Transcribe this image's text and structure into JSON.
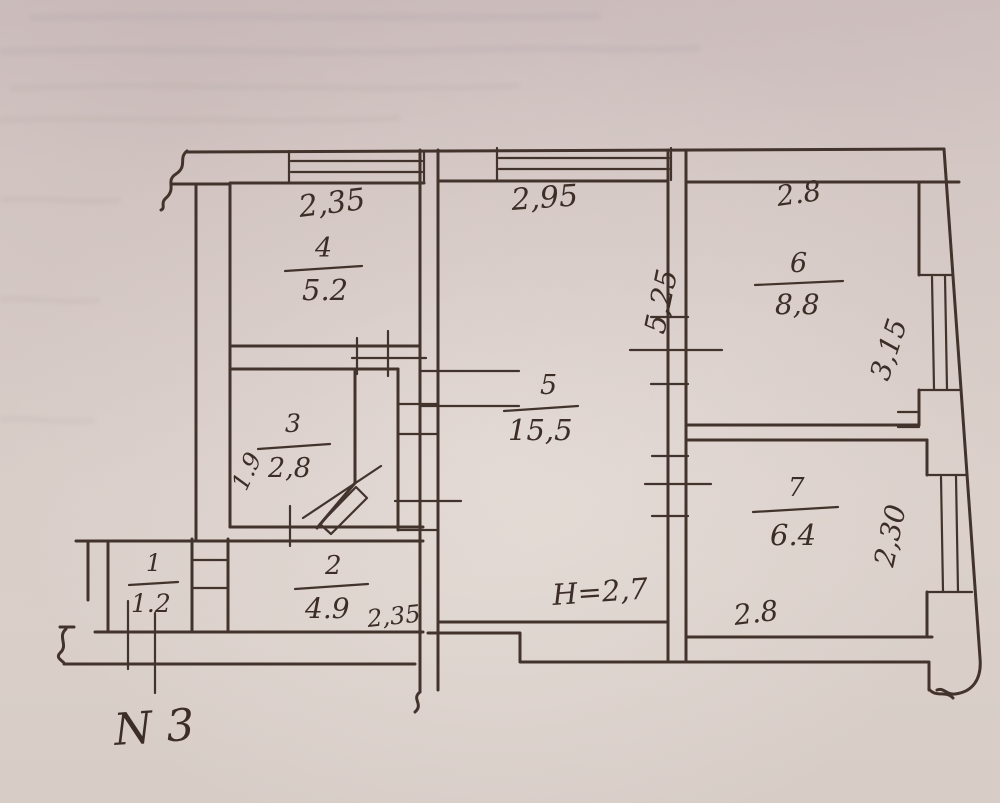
{
  "title": "apartment floor plan sketch",
  "apartment_label": "N 3",
  "colors": {
    "paper": "#d6cbc7",
    "ink": "#42342c"
  },
  "rooms": {
    "r1": {
      "number": "1",
      "area": "1.2"
    },
    "r2": {
      "number": "2",
      "area": "4.9",
      "width": "2,35"
    },
    "r3": {
      "number": "3",
      "area": "2,8",
      "depth": "1.9"
    },
    "r4": {
      "number": "4",
      "area": "5.2",
      "width": "2,35"
    },
    "r5": {
      "number": "5",
      "area": "15,5",
      "width": "2,95",
      "depth": "5,25",
      "height_note": "H=2,7"
    },
    "r6": {
      "number": "6",
      "area": "8,8",
      "width": "2.8",
      "depth": "3,15"
    },
    "r7": {
      "number": "7",
      "area": "6.4",
      "width": "2.8",
      "depth": "2,30"
    }
  }
}
